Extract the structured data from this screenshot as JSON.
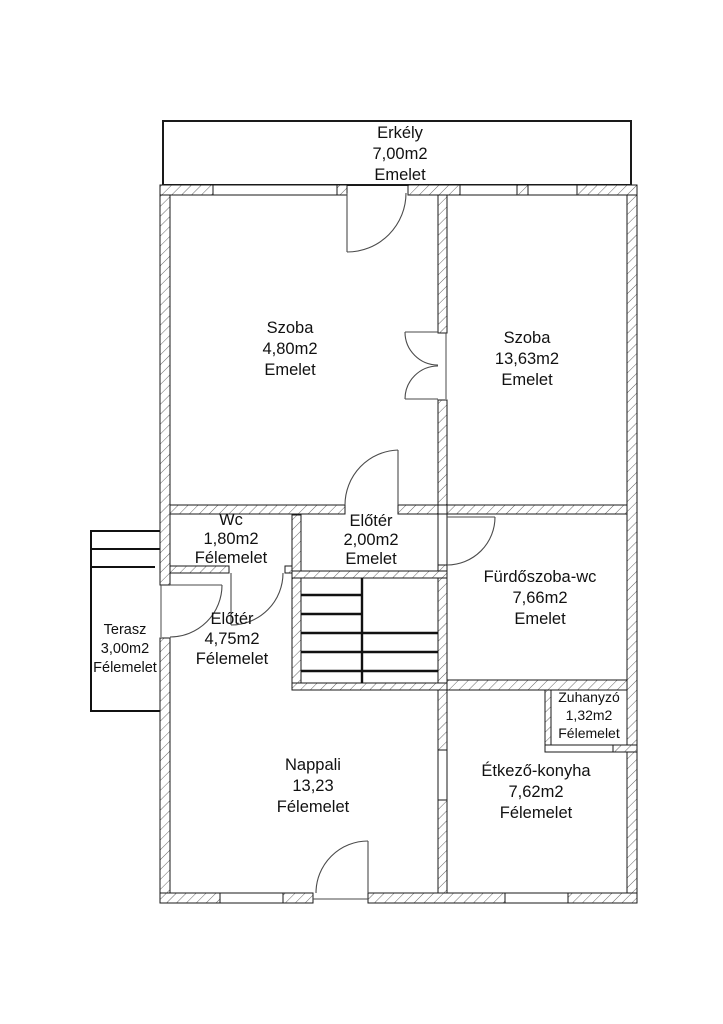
{
  "plan_title": "floor-plan",
  "colors": {
    "line": "#1a1a1a",
    "hatch": "#666666",
    "background": "#ffffff",
    "text": "#111111"
  },
  "rooms": {
    "erkely": {
      "name": "Erkély",
      "area": "7,00m2",
      "level": "Emelet"
    },
    "szoba_left": {
      "name": "Szoba",
      "area": "4,80m2",
      "level": "Emelet"
    },
    "szoba_right": {
      "name": "Szoba",
      "area": "13,63m2",
      "level": "Emelet"
    },
    "wc": {
      "name": "Wc",
      "area": "1,80m2",
      "level": "Félemelet"
    },
    "eloter_upper": {
      "name": "Előtér",
      "area": "2,00m2",
      "level": "Emelet"
    },
    "furdoszoba": {
      "name": "Fürdőszoba-wc",
      "area": "7,66m2",
      "level": "Emelet"
    },
    "eloter_lower": {
      "name": "Előtér",
      "area": "4,75m2",
      "level": "Félemelet"
    },
    "terasz": {
      "name": "Terasz",
      "area": "3,00m2",
      "level": "Félemelet"
    },
    "nappali": {
      "name": "Nappali",
      "area": "13,23",
      "level": "Félemelet"
    },
    "zuhanyzo": {
      "name": "Zuhanyzó",
      "area": "1,32m2",
      "level": "Félemelet"
    },
    "etkezo": {
      "name": "Étkező-konyha",
      "area": "7,62m2",
      "level": "Félemelet"
    }
  }
}
